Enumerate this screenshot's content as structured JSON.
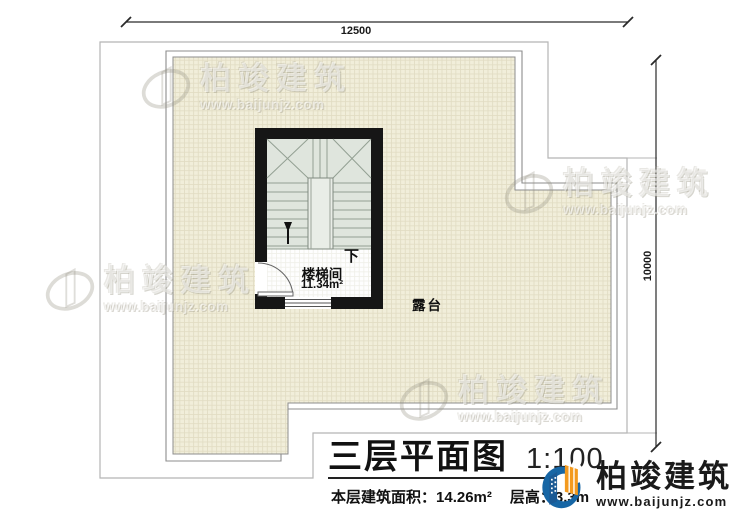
{
  "plan": {
    "dimensions": {
      "top": "12500",
      "right": "10000"
    },
    "stairwell": {
      "name": "楼梯间",
      "area": "11.34m²",
      "direction_label": "下"
    },
    "terrace_label": "露台"
  },
  "footer": {
    "title": "三层平面图",
    "scale": "1:100",
    "area_label": "本层建筑面积：",
    "area_value": "14.26m²",
    "floor_height_label": "层高：",
    "floor_height_value": "3.3m"
  },
  "brand": {
    "name": "柏竣建筑",
    "url": "www.baijunjz.com"
  },
  "watermark": {
    "name": "柏竣建筑",
    "url": "www.baijunjz.com"
  },
  "colors": {
    "wall": "#161616",
    "terrace_fill": "#f1eeda",
    "stair_fill": "#dfe5dd",
    "outline_gray": "#b5b5b5",
    "logo_blue": "#1766a5",
    "logo_orange": "#f39a1e"
  }
}
